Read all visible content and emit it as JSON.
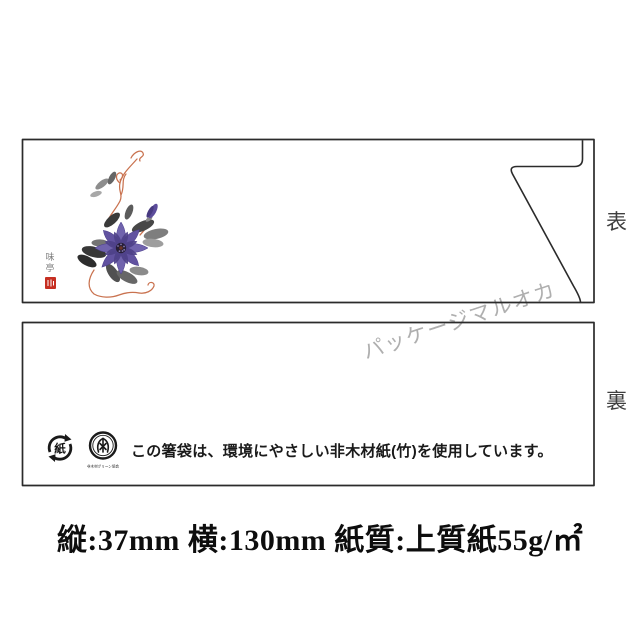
{
  "front_sleeve": {
    "side_label": "表",
    "signature_top": "味",
    "signature_bottom": "亭"
  },
  "back_sleeve": {
    "side_label": "裏",
    "paper_recycle_mark_text": "紙",
    "nonwood_mark_caption": "非木材グリーン協会",
    "notice": "この箸袋は、環境にやさしい非木材紙(竹)を使用しています。"
  },
  "watermark": {
    "text": "パッケージマルオカ"
  },
  "specs": {
    "text": "縦:37mm 横:130mm 紙質:上質紙55g/㎡"
  },
  "colors": {
    "outline": "#2b2b2b",
    "flower_purple": "#6152a0",
    "flower_purple_dark": "#4e4189",
    "flower_center": "#261e36",
    "leaf_ink_dark": "#2d2d2d",
    "leaf_ink_light": "#9e9e9e",
    "vine_orange": "#c9724f",
    "seal_red": "#c62f22",
    "watermark_gray": "#9c9c9c"
  }
}
